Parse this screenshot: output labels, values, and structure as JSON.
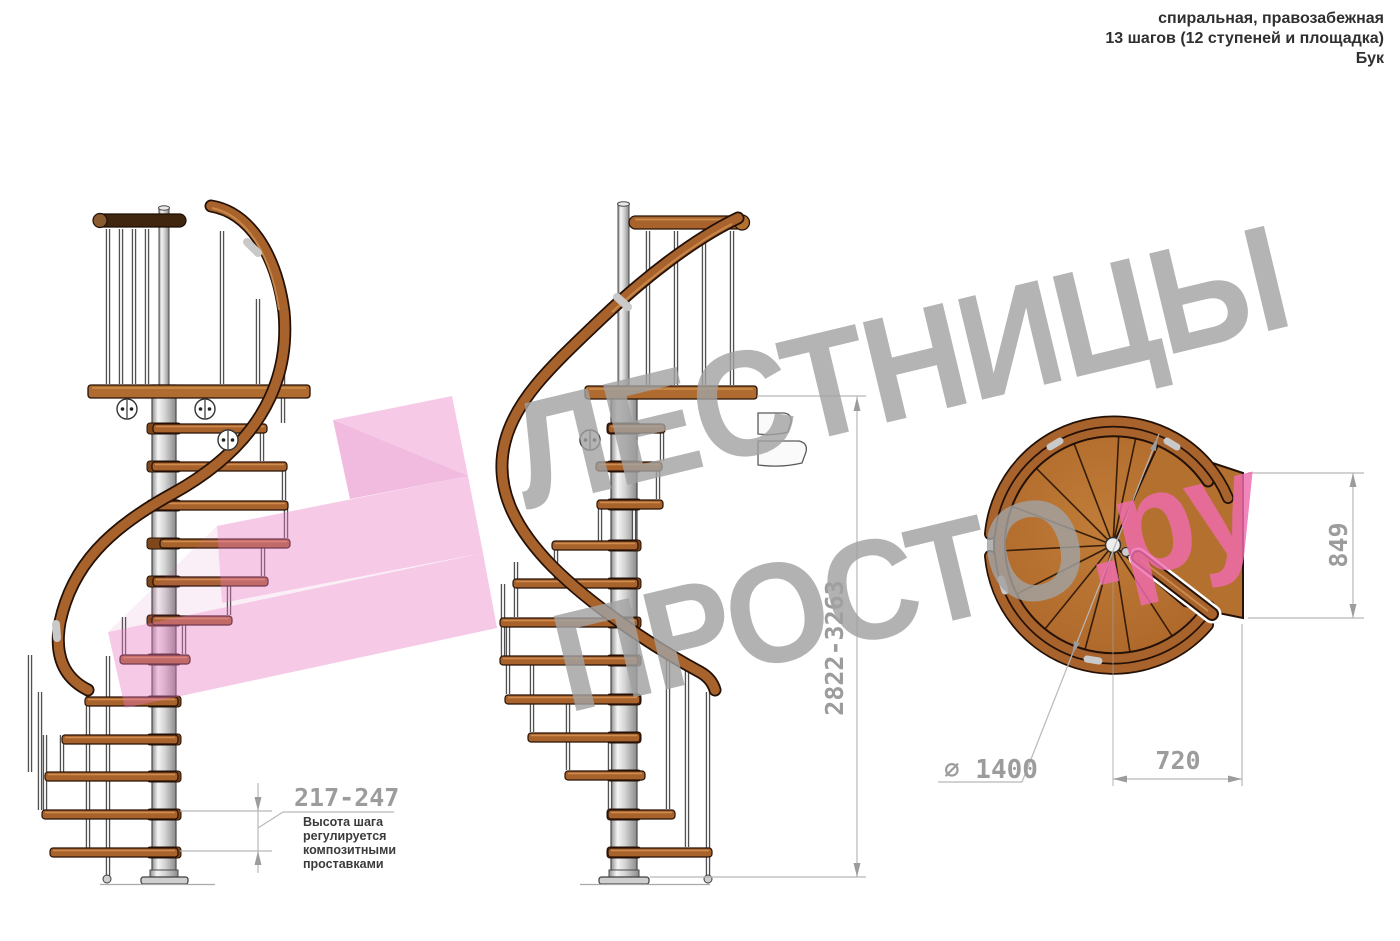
{
  "header": {
    "line1": "спиральная, правозабежная",
    "line2": "13 шагов (12 ступеней и площадка)",
    "line3": "Бук"
  },
  "watermark": {
    "title": "ЛЕСТНИЦЫ",
    "subtitle_gray": "ПРОСТО",
    "subtitle_pink": ".ру"
  },
  "dimensions": {
    "total_height": "2822-3263",
    "step_height": "217-247",
    "note_lines": [
      "Высота шага",
      "регулируется",
      "композитными",
      "проставками"
    ],
    "plan_depth": "849",
    "plan_width": "720",
    "diameter": "⌀ 1400"
  },
  "colors": {
    "wood": "#a8622c",
    "wood_dark": "#241106",
    "steel": "#d9d9d9",
    "dim_gray": "#9c9c9c",
    "line_gray": "#b8b8b8",
    "watermark_gray": "#a2a2a2",
    "watermark_pink": "#ef6cae",
    "arrow_pink": "#e878c3"
  }
}
